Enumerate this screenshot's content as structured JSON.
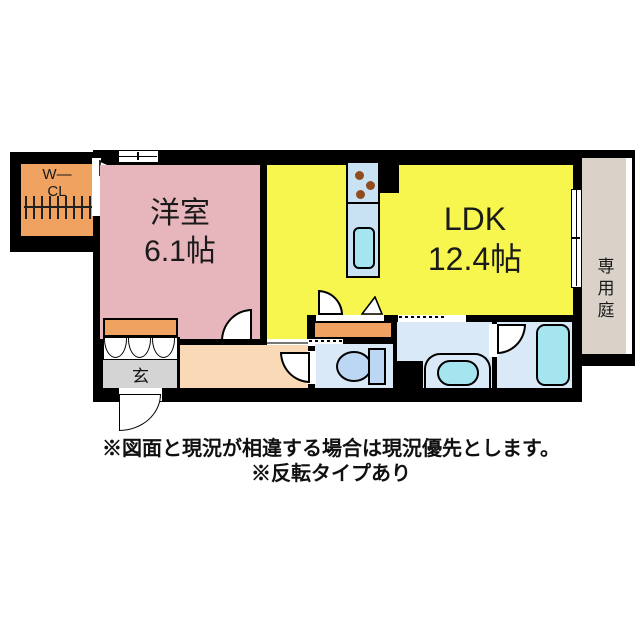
{
  "floorplan": {
    "wcl": {
      "line1": "W—",
      "line2": "CL"
    },
    "western_room": {
      "name": "洋室",
      "size": "6.1帖"
    },
    "ldk": {
      "name": "LDK",
      "size": "12.4帖"
    },
    "garden": {
      "name": "専用庭"
    },
    "entrance": {
      "name": "玄"
    },
    "colors": {
      "wall": "#000000",
      "western-room": "#E7B5BC",
      "ldk": "#F7F64F",
      "storage": "#F0A360",
      "hallway": "#F9D9B6",
      "entrance": "#D4D4D4",
      "wet-room": "#D9E9F8",
      "fixture": "#BBD7F3",
      "tub": "#A5E5F0",
      "kitchen": "#C8E1F3",
      "garden": "#DAD2C8",
      "burner": "#8F4D1E"
    }
  },
  "notes": {
    "line1": "※図面と現況が相違する場合は現況優先とします。",
    "line2": "※反転タイプあり"
  }
}
